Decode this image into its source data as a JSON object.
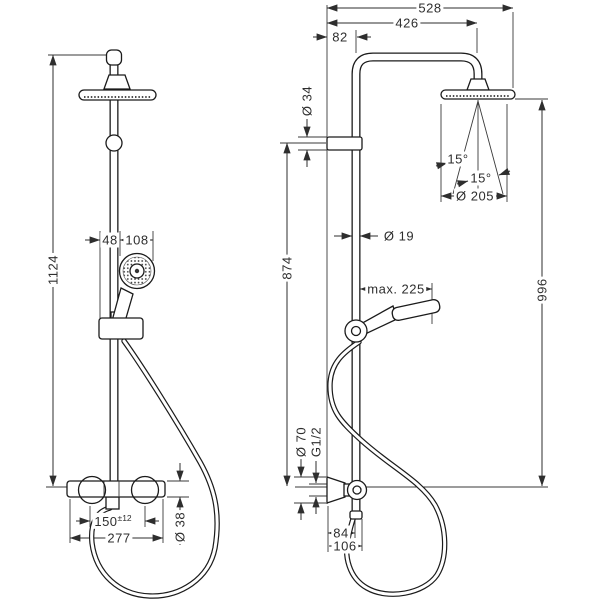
{
  "drawing": {
    "kind": "shower-system-installation-diagram",
    "front_view": {
      "dims": {
        "height": "1124",
        "hand_offset": "48",
        "hand_width": "108",
        "valve_centers": "150",
        "valve_centers_tol": "±12",
        "valve_width": "277",
        "valve_dia": "Ø 38"
      }
    },
    "side_view": {
      "dims": {
        "total_depth": "528",
        "head_reach": "426",
        "wall_offset": "82",
        "bracket_dia": "Ø 34",
        "bar_height": "874",
        "pipe_dia": "Ø 19",
        "hand_reach": "max. 225",
        "head_height": "996",
        "head_dia": "Ø 205",
        "spray_angle_left": "15°",
        "spray_angle_right": "15°",
        "escutcheon_dia": "Ø 70",
        "thread": "G1/2",
        "outlet_offset": "84",
        "hose_offset": "106"
      }
    },
    "line_color": "#2e2e2e",
    "background": "#ffffff"
  }
}
